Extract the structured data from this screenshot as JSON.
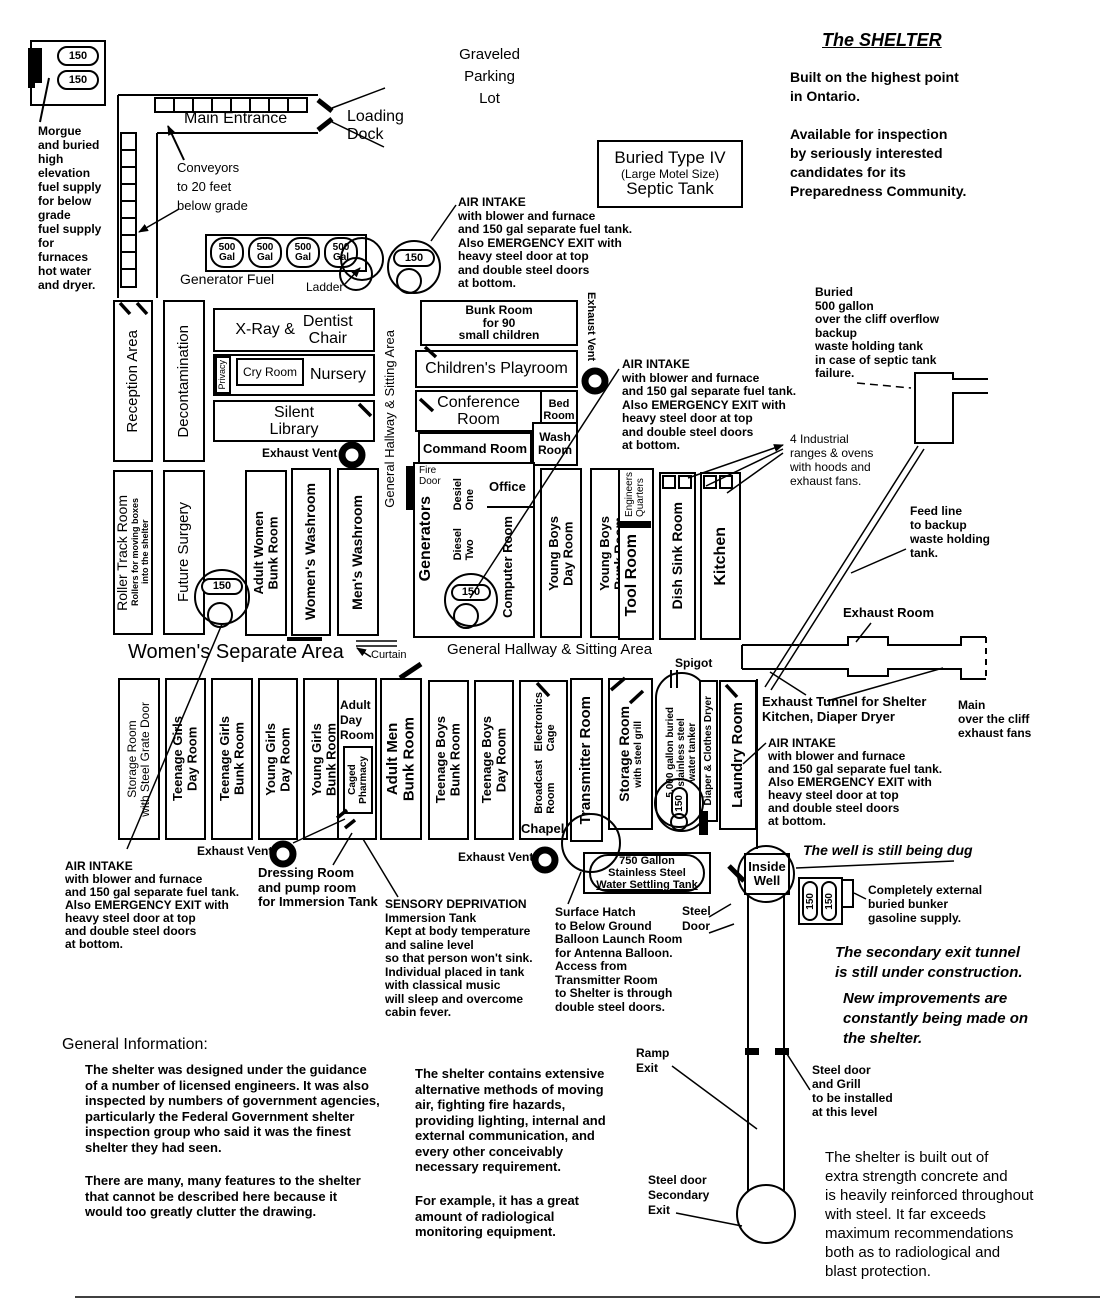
{
  "colors": {
    "ink": "#000000",
    "paper": "#ffffff"
  },
  "title_block": {
    "title": "The SHELTER",
    "p1": "Built on the highest point\nin Ontario.",
    "p2": "Available for inspection\nby seriously interested\ncandidates for its\nPreparedness Community."
  },
  "site": {
    "parking": "Graveled\nParking\nLot",
    "main_entrance": "Main Entrance",
    "loading_dock": "Loading\nDock",
    "conveyors": "Conveyors\nto 20 feet\nbelow grade",
    "morgue_note": "Morgue\nand buried\nhigh\nelevation\nfuel supply\nfor below\ngrade\nfuel supply\nfor\nfurnaces\nhot water\nand dryer.",
    "generator_fuel": "Generator Fuel",
    "ladder": "Ladder",
    "septic_line1": "Buried Type IV",
    "septic_line2": "(Large Motel Size)",
    "septic_line3": "Septic Tank",
    "cap_150": "150",
    "cap_500": "500\nGal"
  },
  "rooms": {
    "reception": "Reception Area",
    "decontamination": "Decontamination",
    "roller_track": "Roller Track Room",
    "roller_track_sub": "Rollers for moving boxes\ninto the shelter",
    "future_surgery": "Future Surgery",
    "xray": "X-Ray &",
    "dentist": "Dentist\nChair",
    "privacy": "Privacy",
    "cry_room": "Cry Room",
    "nursery": "Nursery",
    "silent_library": "Silent\nLibrary",
    "bunk_children": "Bunk Room\nfor 90\nsmall children",
    "childrens_playroom": "Children's Playroom",
    "conference": "Conference\nRoom",
    "bed_room": "Bed\nRoom",
    "command": "Command Room",
    "wash_room": "Wash\nRoom",
    "hallway_upper": "General Hallway & Sitting Area",
    "hallway_lower": "General Hallway & Sitting Area",
    "womens_separate": "Women's Separate Area",
    "adult_women_bunk": "Adult Women\nBunk Room",
    "womens_washroom": "Women's Washroom",
    "mens_washroom": "Men's Washroom",
    "fire_door": "Fire\nDoor",
    "generators": "Generators",
    "diesel_one": "Desiel\nOne",
    "diesel_two": "Diesel\nTwo",
    "office": "Office",
    "computer": "Computer Room",
    "young_boys_day": "Young Boys\nDay Room",
    "young_boys_bunk": "Young Boys\nBunk Room",
    "engineers_quarters": "Engineers\nQuarters",
    "tool_room": "Tool Room",
    "dish_sink": "Dish Sink Room",
    "kitchen": "Kitchen",
    "storage_grate": "Storage Room\nwith Steel Grate Door",
    "teenage_girls_day": "Teenage Girls\nDay Room",
    "teenage_girls_bunk": "Teenage Girls\nBunk Room",
    "young_girls_day": "Young Girls\nDay Room",
    "young_girls_bunk": "Young Girls\nBunk Room",
    "adult_day": "Adult\nDay\nRoom",
    "caged_pharmacy": "Caged\nPharmacy",
    "adult_men_bunk": "Adult Men\nBunk Room",
    "teenage_boys_bunk": "Teenage Boys\nBunk Room",
    "teenage_boys_day": "Teenage Boys\nDay Room",
    "electronics_cage": "Electronics\nCage",
    "broadcast_room": "Broadcast\nRoom",
    "chapel": "Chapel",
    "transmitter": "Transmitter Room",
    "storage_grill": "Storage Room",
    "storage_grill_sub": "with steel grill",
    "water_tanker": "5,000 gallon buried\nstainless steel\nwater tanker",
    "diaper_dryer": "Diaper & Clothes Dryer",
    "laundry": "Laundry Room",
    "inside_well": "Inside\nWell",
    "settling_tank": "750 Gallon\nStainless Steel",
    "settling_tank_sub": "Water Settling Tank",
    "exhaust_room": "Exhaust Room"
  },
  "annotations": {
    "air_intake": "AIR INTAKE\nwith blower and furnace\nand 150 gal separate fuel tank.\nAlso EMERGENCY EXIT with\nheavy steel door at top\nand double steel doors\nat bottom.",
    "exhaust_vent": "Exhaust Vent",
    "curtain": "Curtain",
    "spigot": "Spigot",
    "buried_500": "Buried\n500 gallon\nover the cliff overflow\nbackup\nwaste holding tank\nin case of septic tank\nfailure.",
    "industrial": "4 Industrial\nranges & ovens\nwith hoods and\nexhaust fans.",
    "feed_line": "Feed line\nto backup\nwaste holding\ntank.",
    "exhaust_tunnel": "Exhaust Tunnel for Shelter\nKitchen, Diaper Dryer",
    "main_fans": "Main\nover the cliff\nexhaust fans",
    "dressing": "Dressing Room\nand pump room\nfor Immersion Tank",
    "sensory": "SENSORY DEPRIVATION\nImmersion Tank\nKept at body temperature\nand saline level\nso that person won't sink.\nIndividual placed in tank\nwith classical music\nwill sleep and overcome\ncabin fever.",
    "surface_hatch": "Surface Hatch\nto Below Ground\nBalloon Launch Room\nfor Antenna Balloon.\nAccess from\nTransmitter Room\nto Shelter is through\ndouble steel doors.",
    "steel_door": "Steel\nDoor",
    "well_dug": "The well is still being dug",
    "gasoline": "Completely external\nburied bunker\ngasoline supply.",
    "secondary_tunnel": "The secondary exit tunnel\nis still under construction.",
    "improvements": "New improvements are\nconstantly being made on\nthe shelter.",
    "ramp_exit": "Ramp\nExit",
    "steel_grill": "Steel door\nand Grill\nto be installed\nat this level",
    "secondary_exit": "Steel door\nSecondary\nExit",
    "built_out": "The shelter is built out of\nextra strength concrete and\nis heavily reinforced throughout\nwith steel. It far exceeds\nmaximum recommendations\nboth as to radiological and\nblast protection."
  },
  "general_info": {
    "heading": "General Information:",
    "p1": "The shelter was designed under the guidance\nof a number of licensed engineers. It was also\ninspected by numbers of government agencies,\nparticularly the Federal Government shelter\ninspection group who said it was the finest\nshelter they had seen.",
    "p2": "There are many, many features to the shelter\nthat cannot be described here because it\nwould too greatly clutter the drawing.",
    "p3": "The shelter contains extensive\nalternative methods of moving\nair, fighting fire hazards,\nproviding lighting, internal and\nexternal communication, and\nevery other conceivably\nnecessary requirement.",
    "p4": "For example, it has a great\namount of radiological\nmonitoring equipment."
  }
}
